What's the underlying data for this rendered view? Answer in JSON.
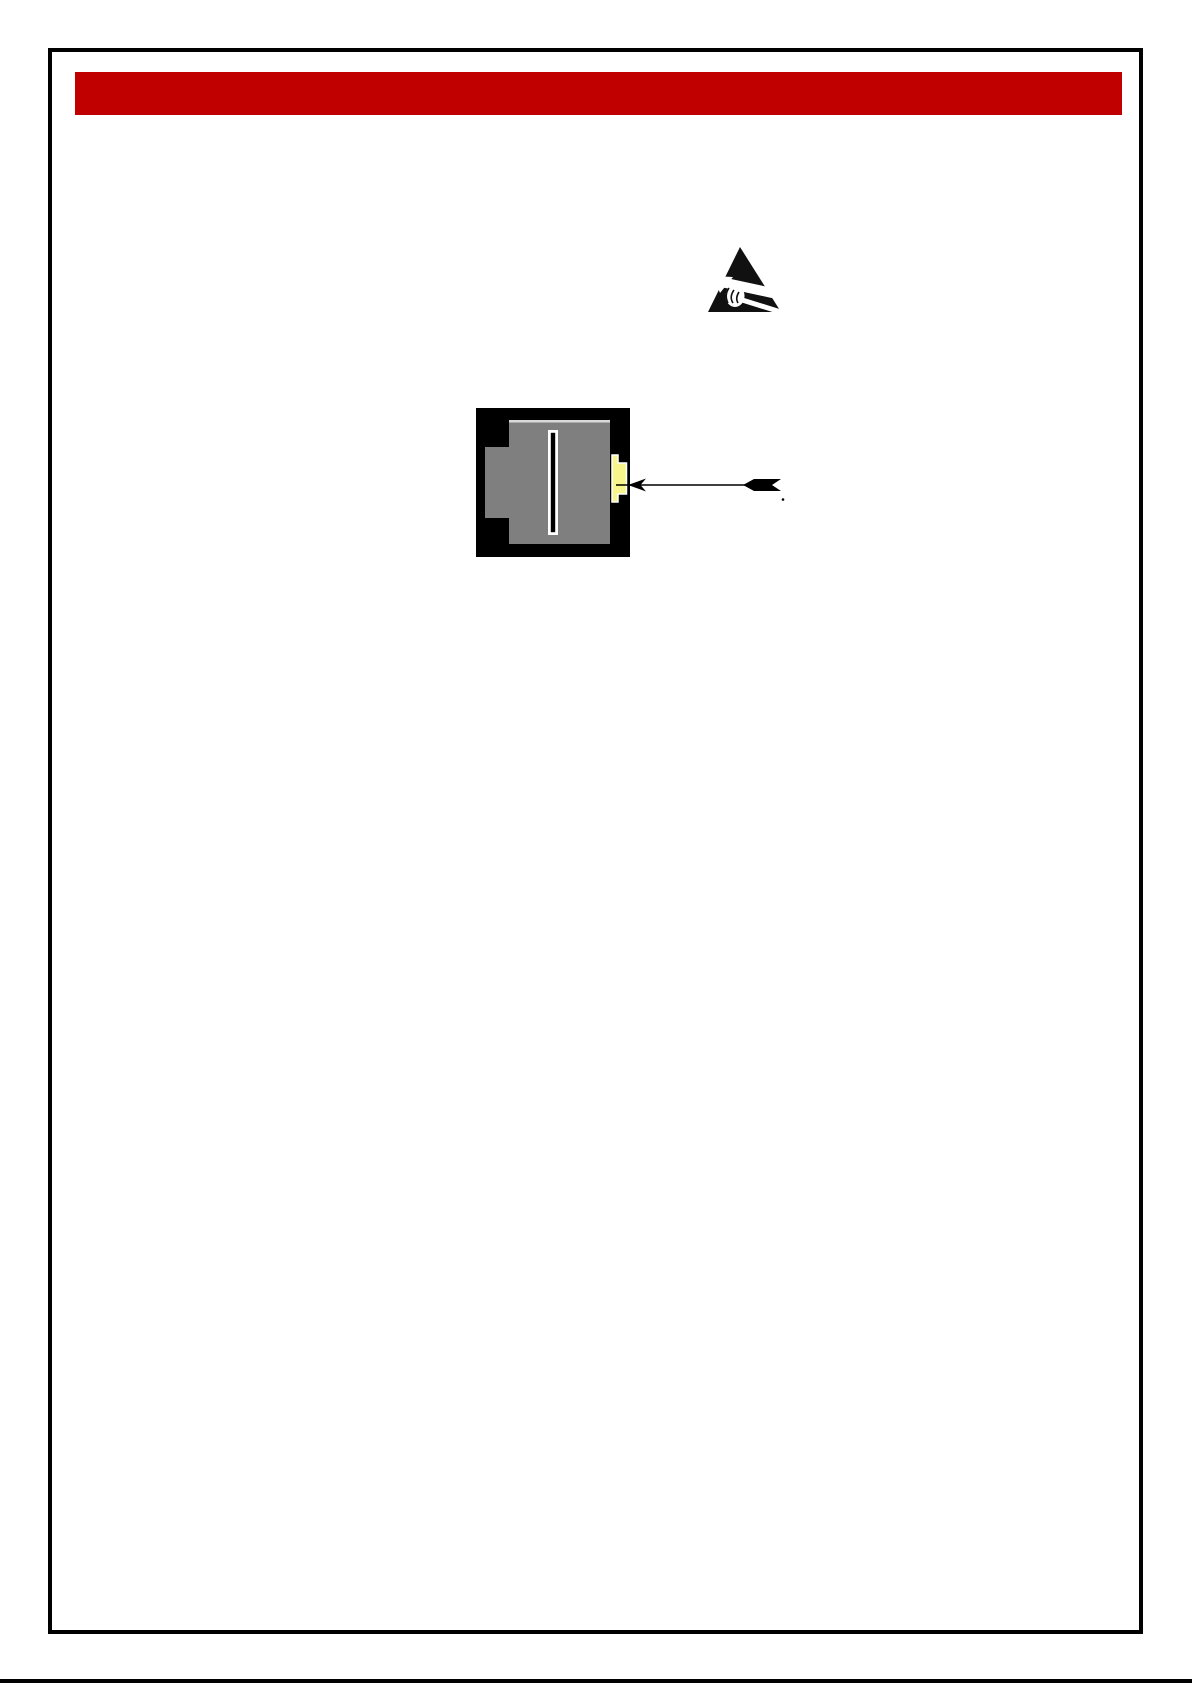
{
  "document": {
    "page_background": "#ffffff",
    "border_color": "#000000",
    "header_bar": {
      "color": "#c00000"
    },
    "esd_symbol": {
      "name": "electrostatic-discharge-warning",
      "triangle_color": "#111111",
      "cutout_color": "#ffffff"
    },
    "connector_figure": {
      "body_color": "#000000",
      "housing_color": "#7f7f7f",
      "housing_highlight_color": "#d9d9d9",
      "slot_outline_color": "#ffffff",
      "slot_color": "#000000",
      "latch_tab_color": "#f8f58d",
      "latch_tab_outline_color": "#ffffff",
      "callout_arrow_color": "#000000"
    },
    "footer_rule": {
      "color": "#000000"
    }
  }
}
